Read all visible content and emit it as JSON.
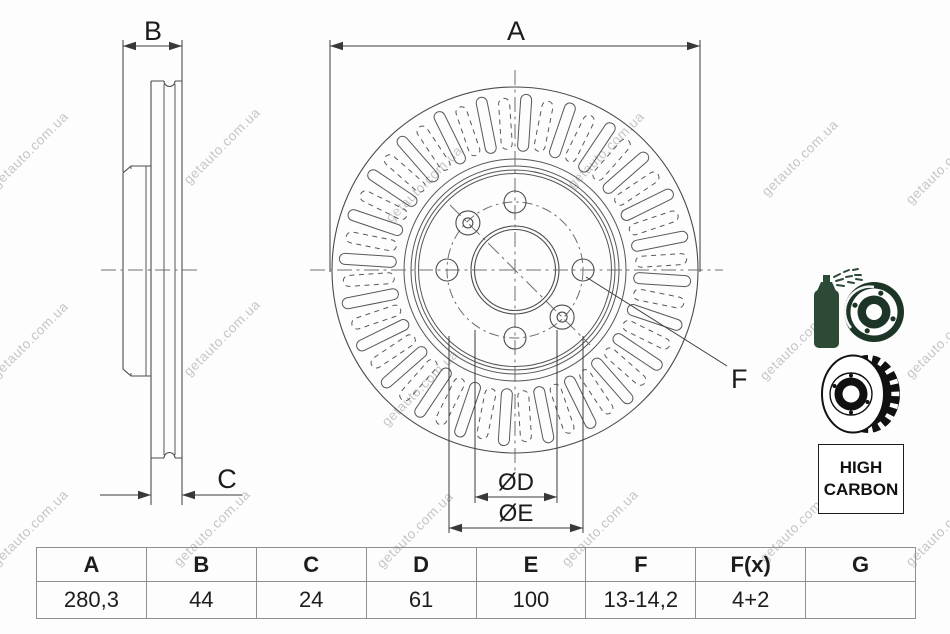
{
  "watermark": {
    "text": "getauto.com.ua"
  },
  "drawing": {
    "dim_labels": {
      "A": "A",
      "B": "B",
      "C": "C",
      "F": "F",
      "D": "ØD",
      "E": "ØE"
    }
  },
  "badges": {
    "high_carbon_line1": "HIGH",
    "high_carbon_line2": "CARBON"
  },
  "icons": {
    "spray": "spray-coated-disc-icon",
    "disc": "vented-disc-icon"
  },
  "table": {
    "headers": [
      "A",
      "B",
      "C",
      "D",
      "E",
      "F",
      "F(x)",
      "G"
    ],
    "values": [
      "280,3",
      "44",
      "24",
      "61",
      "100",
      "13-14,2",
      "4+2",
      ""
    ]
  }
}
